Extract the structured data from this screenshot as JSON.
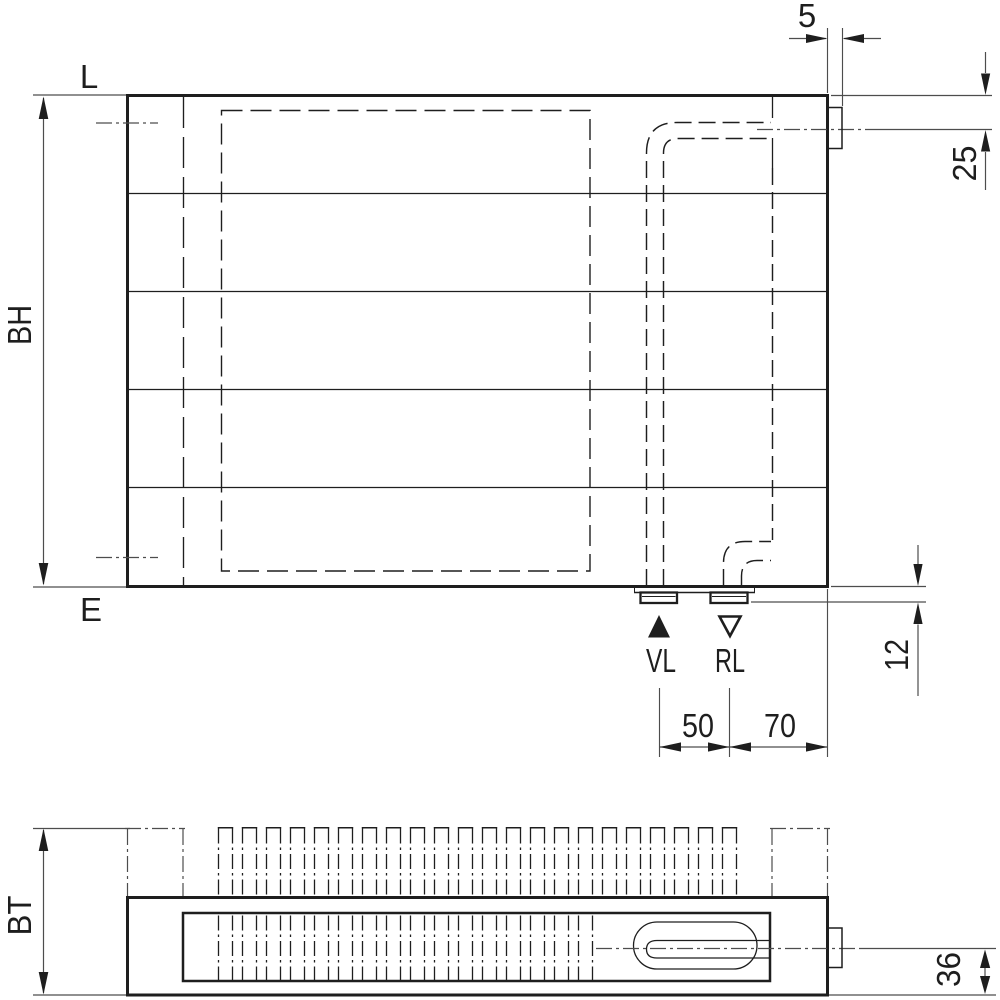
{
  "front_view": {
    "length_label": "L",
    "end_label": "E",
    "height_label": "BH",
    "supply_label": "VL",
    "return_label": "RL",
    "dim_tab": "5",
    "dim_top_offset": "25",
    "dim_stub": "12",
    "dim_spacing": "50",
    "dim_edge_offset": "70"
  },
  "plan_view": {
    "depth_label": "BT",
    "dim_center": "36"
  },
  "colors": {
    "line": "#1e1e1e",
    "thin": "#4d4d4d",
    "bg": "#ffffff"
  }
}
